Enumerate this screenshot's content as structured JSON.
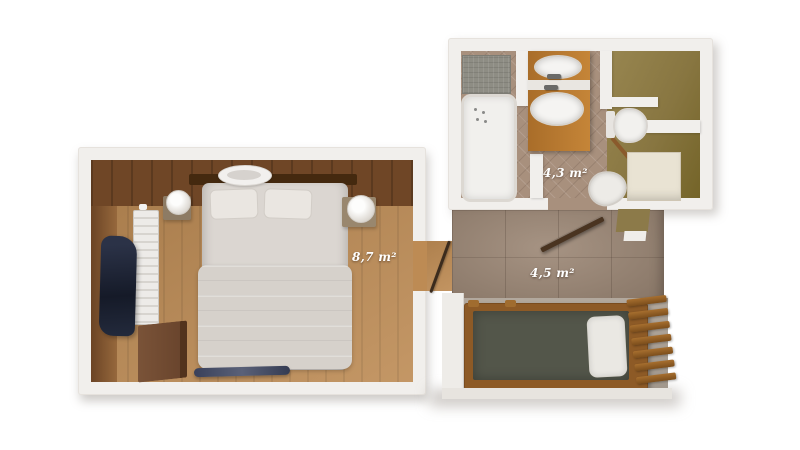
{
  "floor_plan": {
    "rooms": [
      {
        "name": "bedroom",
        "area_label": "8,7 m²"
      },
      {
        "name": "bathroom",
        "area_label": "4,3 m²"
      },
      {
        "name": "hallway",
        "area_label": "4,5 m²"
      }
    ],
    "objects": [
      "double-bed",
      "pillows",
      "headboard",
      "blanket",
      "nightstand-left",
      "nightstand-right",
      "table-lamp-left",
      "table-lamp-right",
      "ceiling-light",
      "radiator",
      "navy-curtain",
      "desk",
      "bench-runner",
      "bedroom-door",
      "bathtub",
      "shower-mat",
      "vanity-double-washbasin",
      "washbasin-faucets",
      "toilet",
      "bidet",
      "bathroom-cabinet",
      "bathroom-door",
      "single-bunk-bed",
      "bunk-mattress",
      "bunk-pillow",
      "bunk-ladder"
    ],
    "colors": {
      "background": "#ffffff",
      "wall": "#f1efec",
      "bedroom_floor": "#bd8b54",
      "bedroom_wall_wood": "#6f4626",
      "bathroom_tile": "#a8907d",
      "wc_floor": "#887641",
      "hallway_tile": "#9c8775",
      "vanity_wood": "#b2742c",
      "bunk_mattress": "#53564a",
      "bunk_frame": "#8d5a26",
      "textile_navy": "#232a3a",
      "bedding": "#dbd6d1",
      "label_text": "#ffffff"
    }
  }
}
